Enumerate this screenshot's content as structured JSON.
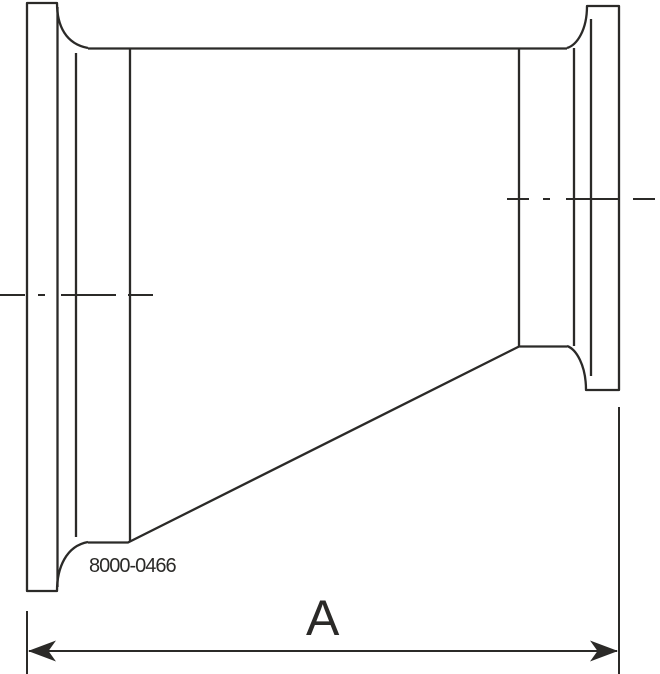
{
  "drawing": {
    "part_number": "8000-0466",
    "dimension_label": "A",
    "description": "eccentric-reducer-clamp-ends-side-view"
  },
  "colors": {
    "line": "#2b2a28",
    "background": "#ffffff"
  }
}
